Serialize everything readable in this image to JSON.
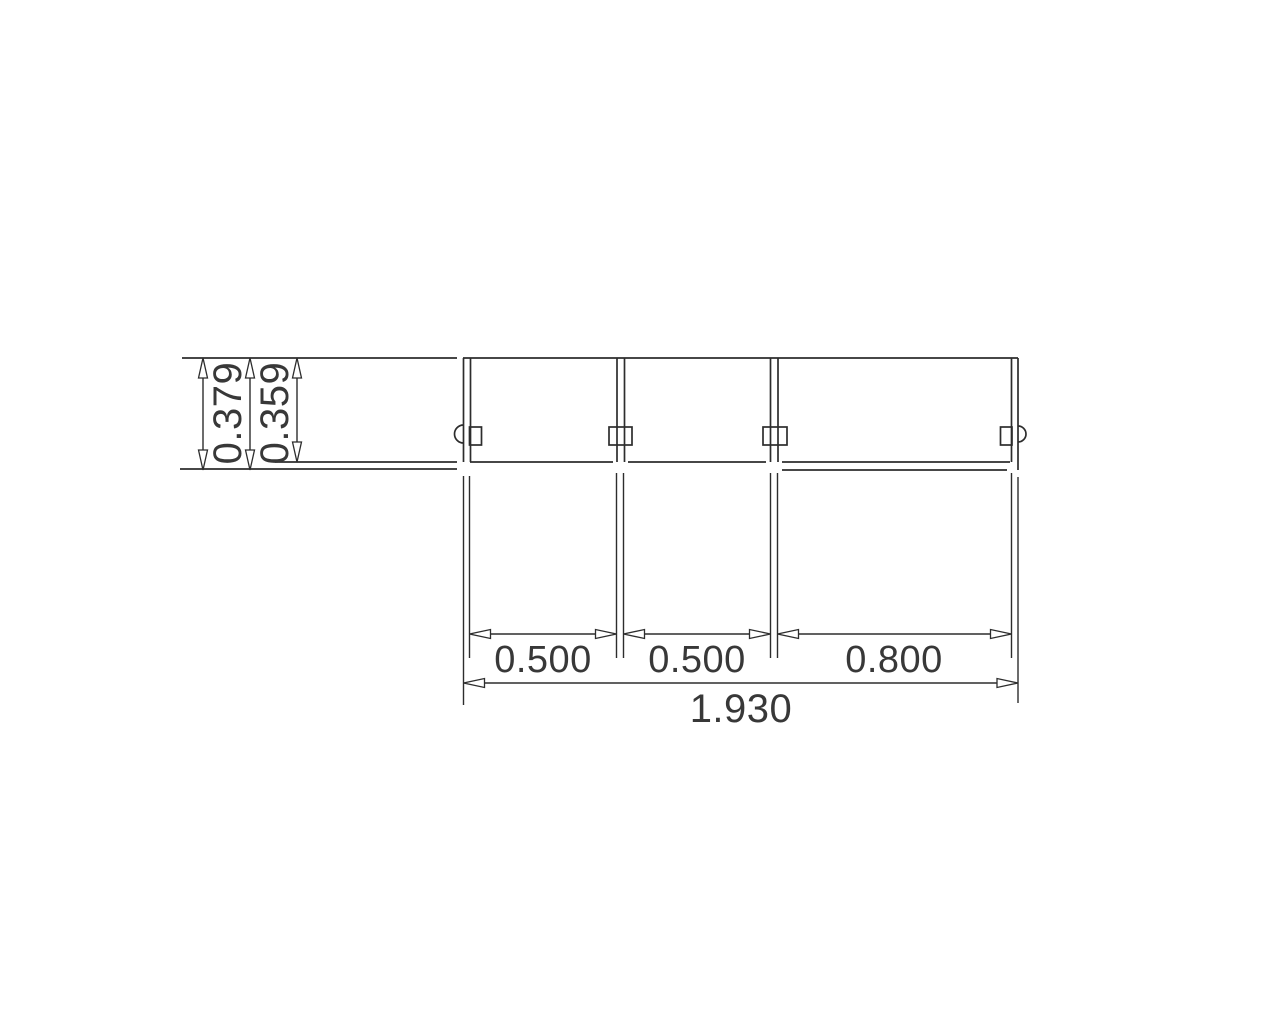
{
  "drawing": {
    "type": "technical-dimension-drawing",
    "background_color": "#ffffff",
    "line_color": "#2d2d2d",
    "dims": {
      "height_outer": "0.379",
      "height_inner": "0.359",
      "bay1": "0.500",
      "bay2": "0.500",
      "bay3": "0.800",
      "total": "1.930"
    }
  }
}
